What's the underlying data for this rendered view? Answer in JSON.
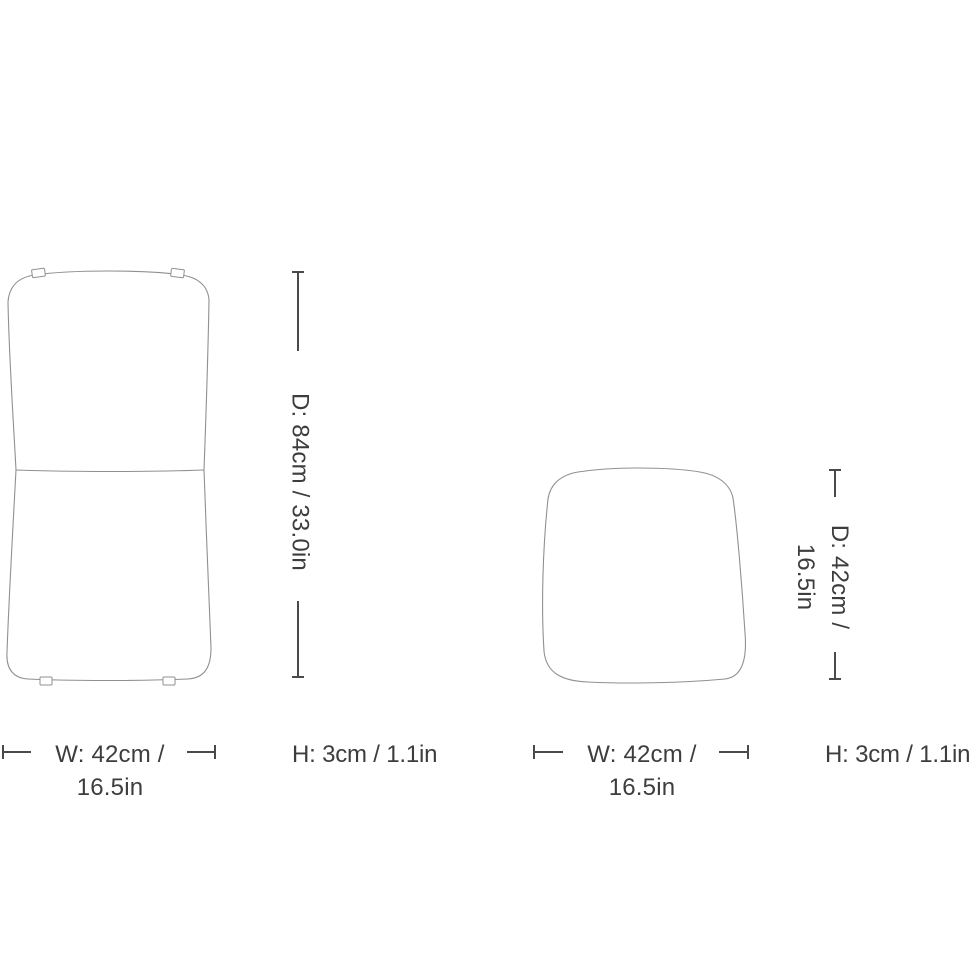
{
  "colors": {
    "outline": "#909090",
    "dimension_line": "#4a4a4a",
    "text": "#3d3d3d",
    "background": "#ffffff"
  },
  "figures": {
    "full_cover": {
      "depth_line1": "D: 84cm / 33.0in",
      "width_line1": "W: 42cm /",
      "width_line2": "16.5in",
      "height_label": "H: 3cm / 1.1in"
    },
    "seat_pad": {
      "depth_line1": "D: 42cm /",
      "depth_line2": "16.5in",
      "width_line1": "W: 42cm /",
      "width_line2": "16.5in",
      "height_label": "H: 3cm / 1.1in"
    }
  }
}
